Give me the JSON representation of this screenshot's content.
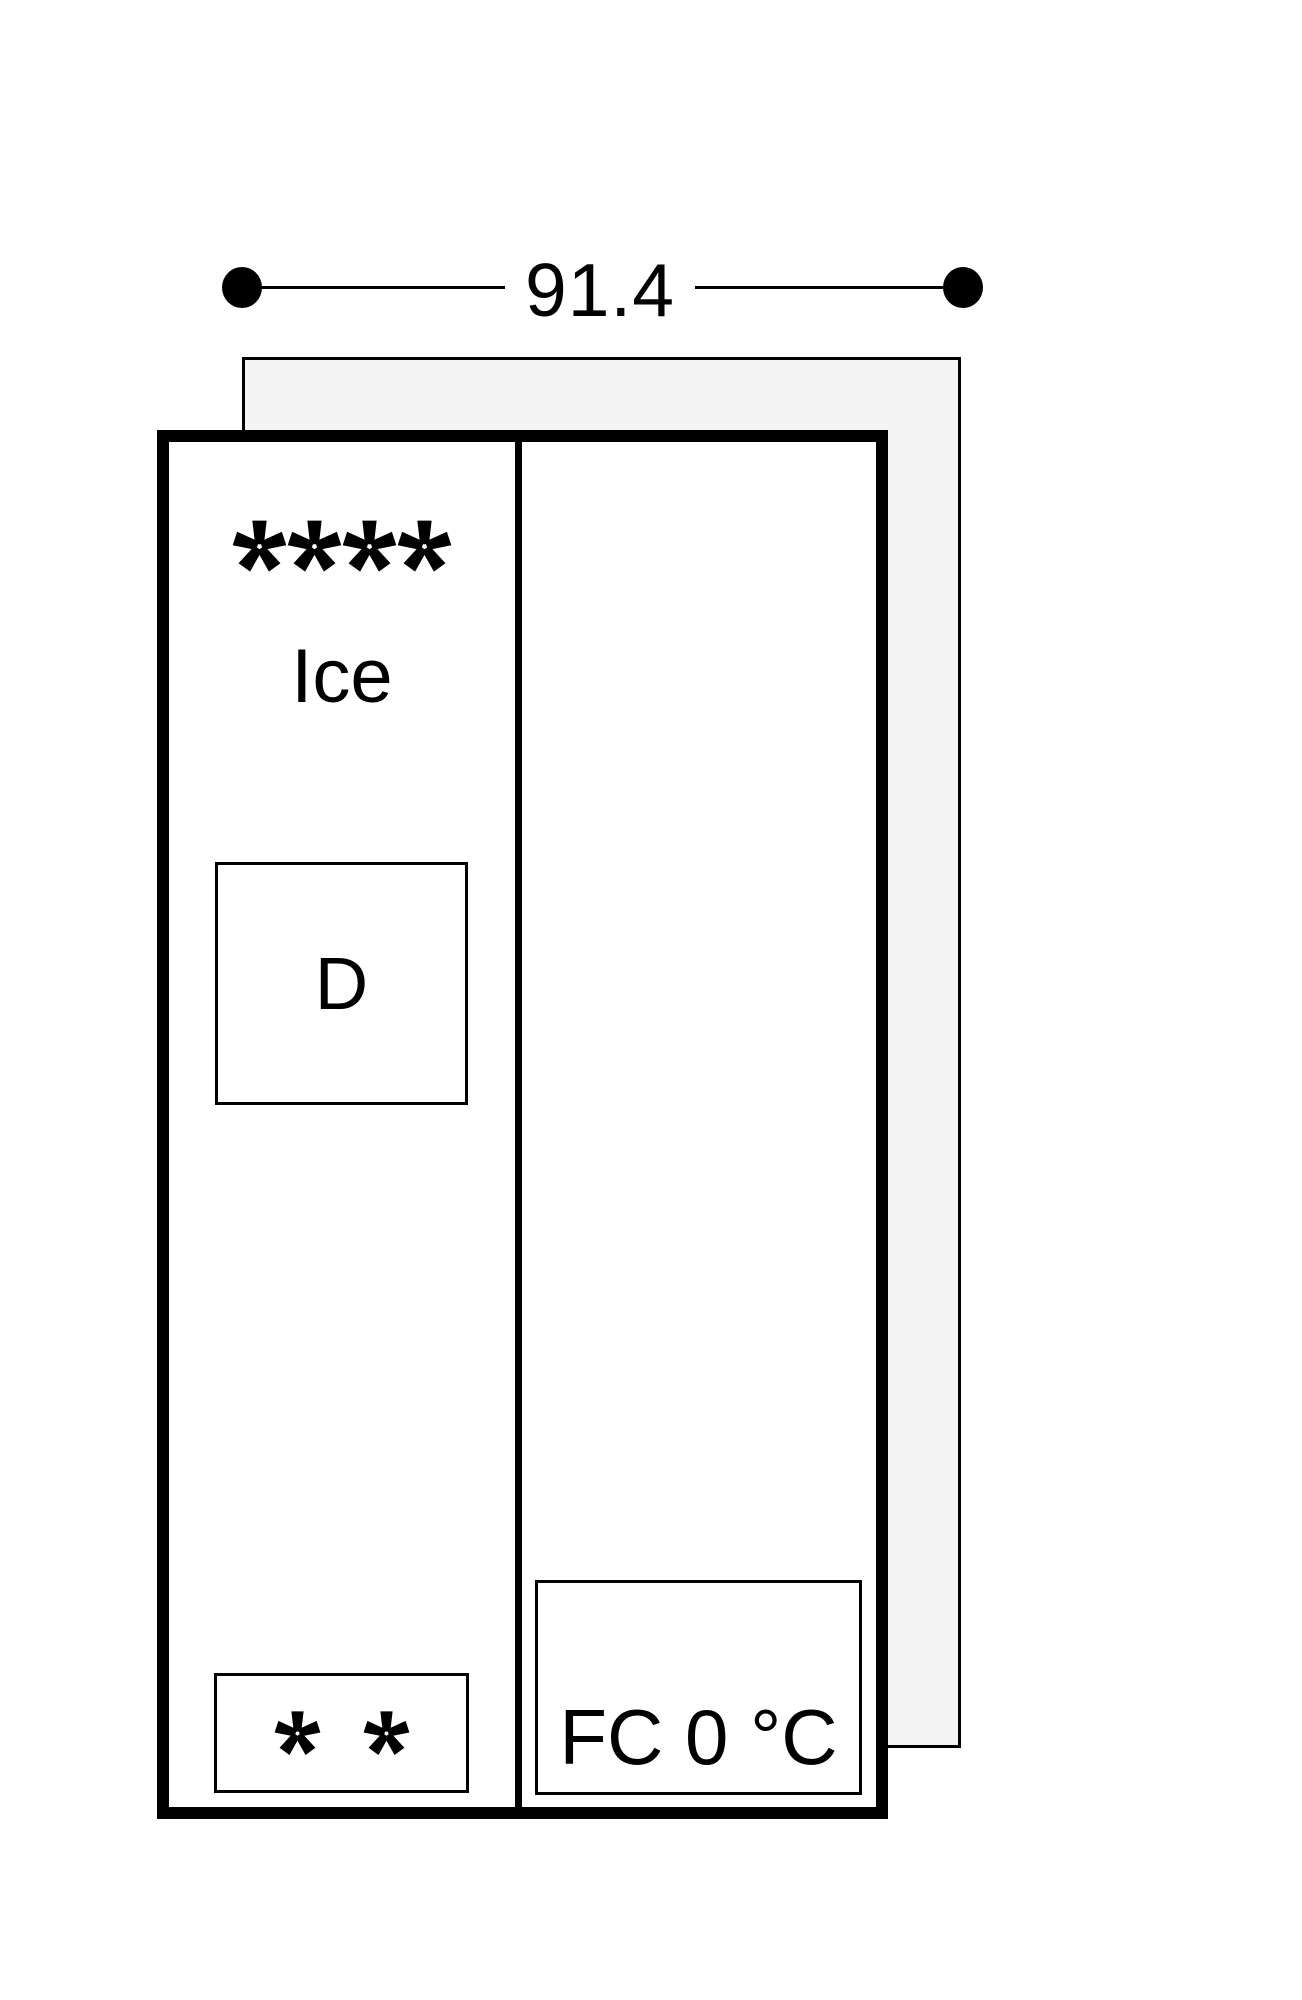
{
  "dimension": {
    "width_label": "91.4",
    "endpoint_icon": "dot-endpoint-icon"
  },
  "appliance": {
    "freezer_compartment": {
      "star_rating_count": 4,
      "star_icon": "freezer-star-icon",
      "ice_label": "Ice",
      "dispenser_box_label": "D",
      "two_star_zone_count": 2
    },
    "fresh_cooling_compartment": {
      "label": "FC 0 °C"
    }
  },
  "colors": {
    "ink": "#000000",
    "back_panel_fill": "#f4f4f4",
    "background": "#ffffff"
  }
}
